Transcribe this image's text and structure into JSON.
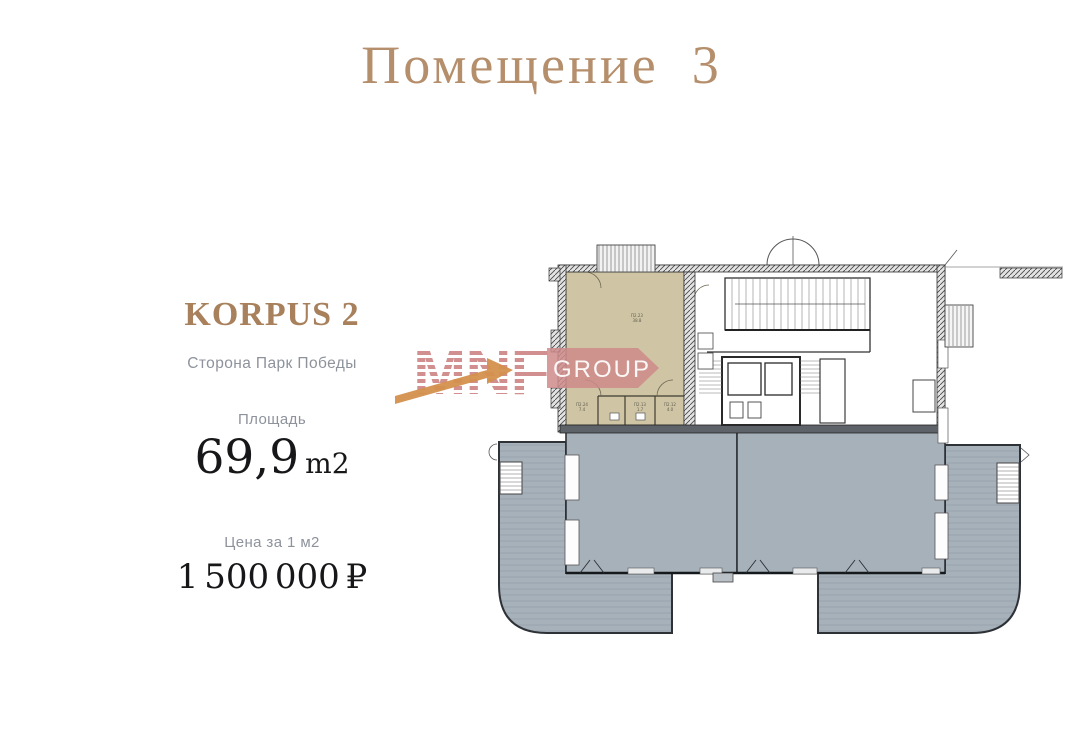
{
  "page": {
    "title": "Помещение  3",
    "background": "#ffffff"
  },
  "info_panel": {
    "building": "KORPUS 2",
    "orientation": "Сторона Парк Победы",
    "area": {
      "label": "Площадь",
      "value": "69,9",
      "unit": "m2"
    },
    "price": {
      "label": "Цена за 1 м2",
      "value": "1 500 000 ₽"
    }
  },
  "watermark": {
    "brand": "MNF",
    "suffix": "GROUP"
  },
  "floorplan": {
    "highlighted_unit": {
      "id": "П2.23",
      "area": "38.8"
    },
    "rooms": [
      {
        "id": "П2.24",
        "area": "7.4"
      },
      {
        "id": "П2.13",
        "area": "1.7"
      },
      {
        "id": "П2.12",
        "area": "4.0"
      }
    ]
  },
  "colors": {
    "title_accent": "#b58e6c",
    "building_accent": "#a8805c",
    "muted_text": "#8d929b",
    "dark_text": "#17171a",
    "unit_highlight": "#cfc5a5",
    "neighbor_gray": "#a7b1ba",
    "watermark_red": "#cf8a8a",
    "arrow_orange": "#d3904d"
  }
}
